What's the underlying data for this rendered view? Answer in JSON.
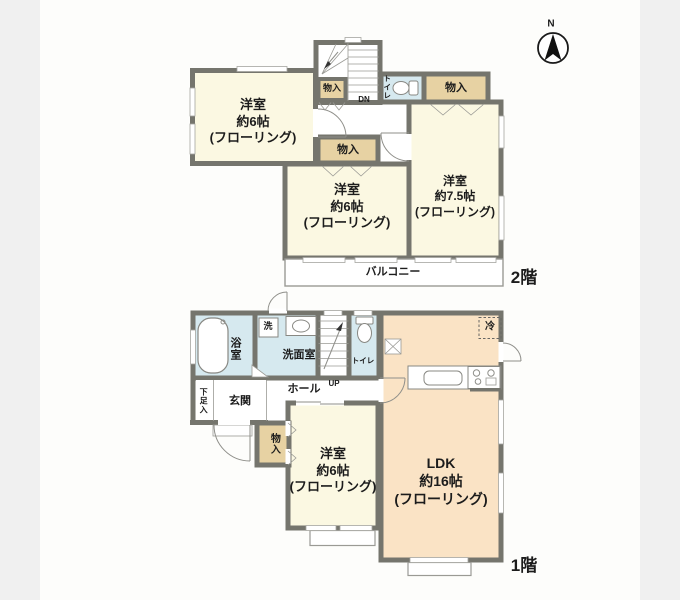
{
  "compass": {
    "label": "N"
  },
  "colors": {
    "wall": "#75756d",
    "room_cream": "#fbf8e2",
    "storage_tan": "#e7d2a3",
    "water_blue": "#d6e9ef",
    "ldk_peach": "#fae3c5",
    "balcony_white": "#ffffff",
    "background": "#f0f0f0",
    "paper": "#fdfdfb"
  },
  "floor2": {
    "label": "2階",
    "room_nw": {
      "name": "洋室",
      "size": "約6帖",
      "finish": "(フローリング)"
    },
    "room_s": {
      "name": "洋室",
      "size": "約6帖",
      "finish": "(フローリング)"
    },
    "room_e": {
      "name": "洋室",
      "size": "約7.5帖",
      "finish": "(フローリング)"
    },
    "closet_stair": "物入",
    "closet_mid": "物入",
    "closet_ne": "物入",
    "toilet": "トイレ",
    "stair": "DN",
    "balcony": "バルコニー"
  },
  "floor1": {
    "label": "1階",
    "bath": "浴室",
    "laundry_pan": "洗",
    "washroom": "洗面室",
    "toilet": "トイレ",
    "stair": "UP",
    "hall": "ホール",
    "entrance": "玄関",
    "shoe_cabinet": "下足入",
    "closet": "物入",
    "fridge": "冷",
    "room_s": {
      "name": "洋室",
      "size": "約6帖",
      "finish": "(フローリング)"
    },
    "ldk": {
      "name": "LDK",
      "size": "約16帖",
      "finish": "(フローリング)"
    }
  }
}
